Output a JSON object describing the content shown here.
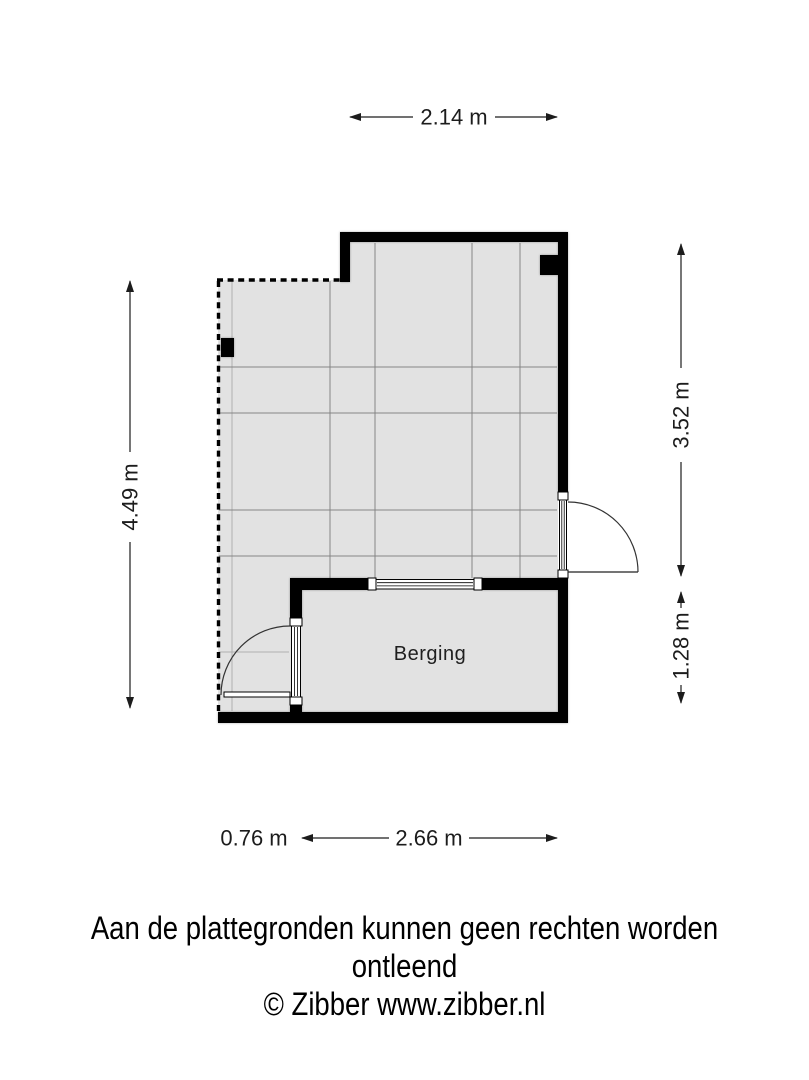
{
  "plan": {
    "room_label": "Berging",
    "dimensions": {
      "top": "2.14 m",
      "left": "4.49 m",
      "right_upper": "3.52 m",
      "right_lower": "1.28 m",
      "bottom_left": "0.76 m",
      "bottom_right": "2.66 m"
    },
    "colors": {
      "wall": "#000000",
      "floor": "#e2e2e2",
      "grid_line": "#858585",
      "dimension_text": "#1c1c1c",
      "background": "#ffffff"
    }
  },
  "footer": {
    "disclaimer": "Aan de plattegronden kunnen geen rechten worden ontleend",
    "copyright": "© Zibber www.zibber.nl"
  }
}
